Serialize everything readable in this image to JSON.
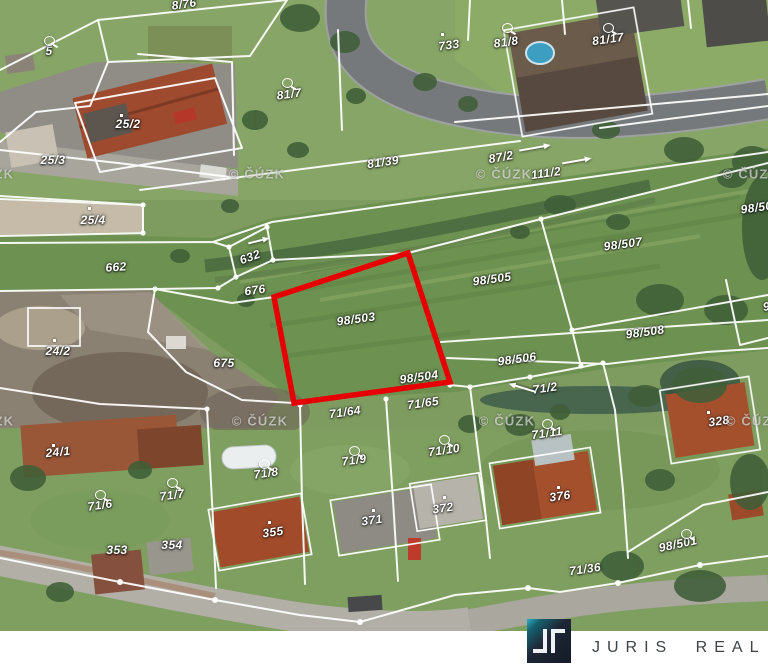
{
  "branding": {
    "name": "JURIS REAL",
    "logo_monogram": "JR",
    "bar_bg": "#ffffff",
    "name_color": "#3f4346",
    "logo_square_dark": "#141b27",
    "logo_square_accent": "#2ab2c6",
    "logo_glyph_color": "#eef2f4"
  },
  "map": {
    "source_watermark": "© ČÚZK",
    "watermark_positions": [
      [
        -14,
        174
      ],
      [
        257,
        174
      ],
      [
        504,
        174
      ],
      [
        751,
        174
      ],
      [
        -14,
        421
      ],
      [
        260,
        421
      ],
      [
        507,
        421
      ],
      [
        754,
        421
      ]
    ],
    "highlight": {
      "parcel": "98/503",
      "color": "#e60005"
    },
    "labels": [
      {
        "t": "8/76",
        "x": 184,
        "y": 4,
        "r": -8
      },
      {
        "t": "5",
        "x": 49,
        "y": 51,
        "r": 0
      },
      {
        "t": "25/2",
        "x": 128,
        "y": 124,
        "r": 0
      },
      {
        "t": "25/3",
        "x": 53,
        "y": 160,
        "r": 0
      },
      {
        "t": "81/7",
        "x": 289,
        "y": 94,
        "r": -8
      },
      {
        "t": "733",
        "x": 449,
        "y": 45,
        "r": -8
      },
      {
        "t": "81/8",
        "x": 506,
        "y": 42,
        "r": -8
      },
      {
        "t": "81/17",
        "x": 608,
        "y": 39,
        "r": -8
      },
      {
        "t": "81/39",
        "x": 383,
        "y": 162,
        "r": -8
      },
      {
        "t": "87/2",
        "x": 501,
        "y": 157,
        "r": -10
      },
      {
        "t": "111/2",
        "x": 546,
        "y": 173,
        "r": -8
      },
      {
        "t": "25/4",
        "x": 93,
        "y": 220,
        "r": 0
      },
      {
        "t": "662",
        "x": 116,
        "y": 267,
        "r": -4
      },
      {
        "t": "632",
        "x": 250,
        "y": 257,
        "r": -20
      },
      {
        "t": "676",
        "x": 255,
        "y": 290,
        "r": -8
      },
      {
        "t": "675",
        "x": 224,
        "y": 363,
        "r": 0
      },
      {
        "t": "98/503",
        "x": 356,
        "y": 319,
        "r": -8
      },
      {
        "t": "98/505",
        "x": 492,
        "y": 279,
        "r": -8
      },
      {
        "t": "98/507",
        "x": 623,
        "y": 244,
        "r": -8
      },
      {
        "t": "98/509",
        "x": 760,
        "y": 207,
        "r": -8
      },
      {
        "t": "98/508",
        "x": 645,
        "y": 332,
        "r": -8
      },
      {
        "t": "98/506",
        "x": 517,
        "y": 359,
        "r": -8
      },
      {
        "t": "98/504",
        "x": 419,
        "y": 377,
        "r": -8
      },
      {
        "t": "71/2",
        "x": 545,
        "y": 388,
        "r": -8
      },
      {
        "t": "71/64",
        "x": 345,
        "y": 412,
        "r": -8
      },
      {
        "t": "71/65",
        "x": 423,
        "y": 403,
        "r": -8
      },
      {
        "t": "71/11",
        "x": 547,
        "y": 433,
        "r": -8
      },
      {
        "t": "328",
        "x": 719,
        "y": 421,
        "r": -8
      },
      {
        "t": "24/2",
        "x": 58,
        "y": 351,
        "r": 0
      },
      {
        "t": "24/1",
        "x": 58,
        "y": 452,
        "r": -6
      },
      {
        "t": "71/6",
        "x": 100,
        "y": 505,
        "r": -8
      },
      {
        "t": "71/7",
        "x": 172,
        "y": 495,
        "r": -8
      },
      {
        "t": "71/8",
        "x": 266,
        "y": 473,
        "r": -8
      },
      {
        "t": "71/9",
        "x": 354,
        "y": 460,
        "r": -8
      },
      {
        "t": "71/10",
        "x": 444,
        "y": 450,
        "r": -8
      },
      {
        "t": "353",
        "x": 117,
        "y": 550,
        "r": 0
      },
      {
        "t": "354",
        "x": 172,
        "y": 545,
        "r": 0
      },
      {
        "t": "355",
        "x": 273,
        "y": 532,
        "r": -8
      },
      {
        "t": "371",
        "x": 372,
        "y": 520,
        "r": -8
      },
      {
        "t": "372",
        "x": 443,
        "y": 508,
        "r": -8
      },
      {
        "t": "376",
        "x": 560,
        "y": 496,
        "r": -8
      },
      {
        "t": "98/501",
        "x": 678,
        "y": 544,
        "r": -12
      },
      {
        "t": "71/36",
        "x": 585,
        "y": 569,
        "r": -8
      },
      {
        "t": "98",
        "x": 770,
        "y": 306,
        "r": -8
      }
    ],
    "symbols": {
      "circles": [
        [
          44,
          36
        ],
        [
          282,
          78
        ],
        [
          502,
          23
        ],
        [
          603,
          23
        ],
        [
          542,
          419
        ],
        [
          95,
          490
        ],
        [
          167,
          478
        ],
        [
          259,
          459
        ],
        [
          349,
          446
        ],
        [
          439,
          435
        ],
        [
          681,
          529
        ]
      ],
      "dots": [
        [
          120,
          114
        ],
        [
          441,
          33
        ],
        [
          88,
          207
        ],
        [
          53,
          339
        ],
        [
          52,
          444
        ],
        [
          268,
          521
        ],
        [
          372,
          509
        ],
        [
          443,
          496
        ],
        [
          557,
          486
        ],
        [
          707,
          411
        ]
      ]
    },
    "arrows": [
      [
        534,
        147,
        -10,
        30
      ],
      [
        576,
        160,
        -10,
        28
      ],
      [
        258,
        240,
        -14,
        20
      ],
      [
        523,
        387,
        197,
        26
      ]
    ]
  }
}
